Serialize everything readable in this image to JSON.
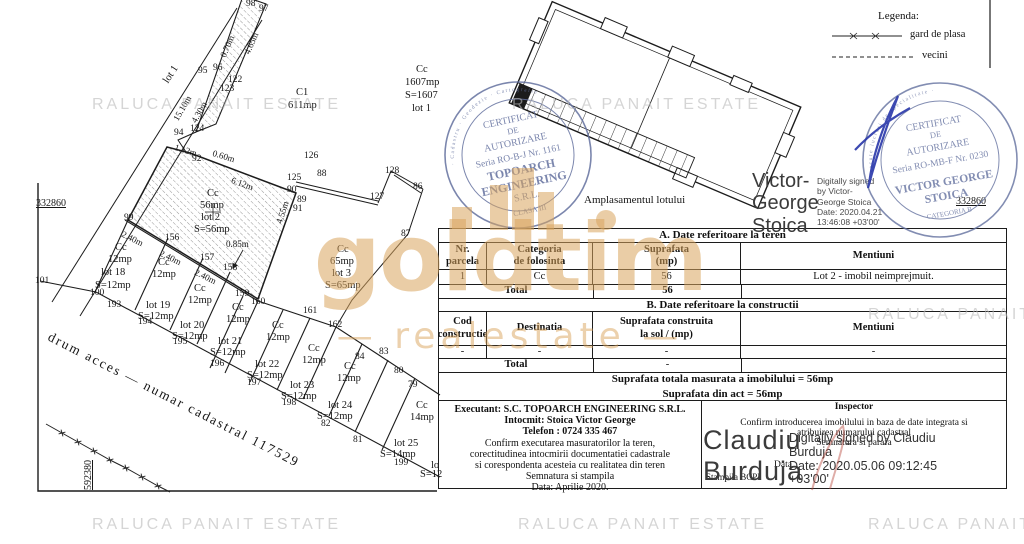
{
  "watermarks": {
    "raluca": "RALUCA PANAIT ESTATE",
    "brand": "goldtim",
    "brand_sub": "— realestate —"
  },
  "legend": {
    "title": "Legenda:",
    "fence_label": "gard de plasa",
    "vecini_label": "vecini"
  },
  "map": {
    "site_plan_caption": "Amplasamentul lotului",
    "labels": [
      {
        "t": "98",
        "x": 246,
        "y": 0
      },
      {
        "t": "97",
        "x": 259,
        "y": 5
      },
      {
        "t": "95",
        "x": 198,
        "y": 67
      },
      {
        "t": "96",
        "x": 213,
        "y": 64
      },
      {
        "t": "122",
        "x": 228,
        "y": 76
      },
      {
        "t": "123",
        "x": 220,
        "y": 85
      },
      {
        "t": "124",
        "x": 190,
        "y": 125
      },
      {
        "t": "94",
        "x": 174,
        "y": 129
      },
      {
        "t": "92",
        "x": 192,
        "y": 155
      },
      {
        "t": "126",
        "x": 304,
        "y": 152
      },
      {
        "t": "125",
        "x": 287,
        "y": 174
      },
      {
        "t": "88",
        "x": 317,
        "y": 170
      },
      {
        "t": "90",
        "x": 287,
        "y": 186
      },
      {
        "t": "89",
        "x": 297,
        "y": 196
      },
      {
        "t": "91",
        "x": 293,
        "y": 205
      },
      {
        "t": "99",
        "x": 124,
        "y": 214
      },
      {
        "t": "156",
        "x": 165,
        "y": 234
      },
      {
        "t": "157",
        "x": 200,
        "y": 254
      },
      {
        "t": "158",
        "x": 223,
        "y": 264
      },
      {
        "t": "159",
        "x": 235,
        "y": 290
      },
      {
        "t": "160",
        "x": 251,
        "y": 298
      },
      {
        "t": "161",
        "x": 303,
        "y": 307
      },
      {
        "t": "162",
        "x": 328,
        "y": 321
      },
      {
        "t": "84",
        "x": 355,
        "y": 353
      },
      {
        "t": "83",
        "x": 379,
        "y": 348
      },
      {
        "t": "80",
        "x": 394,
        "y": 367
      },
      {
        "t": "79",
        "x": 408,
        "y": 381
      },
      {
        "t": "82",
        "x": 321,
        "y": 420
      },
      {
        "t": "81",
        "x": 353,
        "y": 436
      },
      {
        "t": "199",
        "x": 394,
        "y": 459
      },
      {
        "t": "198",
        "x": 282,
        "y": 399
      },
      {
        "t": "197",
        "x": 247,
        "y": 379
      },
      {
        "t": "196",
        "x": 210,
        "y": 360
      },
      {
        "t": "195",
        "x": 173,
        "y": 338
      },
      {
        "t": "194",
        "x": 138,
        "y": 318
      },
      {
        "t": "193",
        "x": 107,
        "y": 301
      },
      {
        "t": "100",
        "x": 90,
        "y": 289
      },
      {
        "t": "101",
        "x": 35,
        "y": 277
      },
      {
        "t": "86",
        "x": 413,
        "y": 183
      },
      {
        "t": "87",
        "x": 401,
        "y": 230
      },
      {
        "t": "127",
        "x": 370,
        "y": 193
      },
      {
        "t": "128",
        "x": 385,
        "y": 167
      },
      {
        "t": "0.70m",
        "x": 219,
        "y": 55,
        "r": -66,
        "c": "d"
      },
      {
        "t": "4.65m",
        "x": 243,
        "y": 52,
        "r": -66,
        "c": "d"
      },
      {
        "t": "15.10m",
        "x": 172,
        "y": 118,
        "r": -60,
        "c": "d"
      },
      {
        "t": "4.30m",
        "x": 190,
        "y": 120,
        "r": -60,
        "c": "d"
      },
      {
        "t": "1.12m",
        "x": 176,
        "y": 143,
        "r": 17,
        "c": "d"
      },
      {
        "t": "0.60m",
        "x": 214,
        "y": 149,
        "r": 17,
        "c": "d"
      },
      {
        "t": "6.12m",
        "x": 233,
        "y": 176,
        "r": 20,
        "c": "d"
      },
      {
        "t": "2.40m",
        "x": 124,
        "y": 230,
        "r": 26,
        "c": "d"
      },
      {
        "t": "2.40m",
        "x": 162,
        "y": 249,
        "r": 26,
        "c": "d"
      },
      {
        "t": "2.40m",
        "x": 197,
        "y": 268,
        "r": 26,
        "c": "d"
      },
      {
        "t": "0.85m",
        "x": 226,
        "y": 240,
        "c": "d"
      },
      {
        "t": "4.55m",
        "x": 275,
        "y": 222,
        "r": -72,
        "c": "d"
      },
      {
        "t": "lot 1",
        "x": 162,
        "y": 80,
        "r": -57,
        "c": "l"
      },
      {
        "t": "Cc",
        "x": 207,
        "y": 189,
        "c": "l"
      },
      {
        "t": "56mp",
        "x": 200,
        "y": 201,
        "c": "l"
      },
      {
        "t": "lot 2",
        "x": 201,
        "y": 213,
        "c": "l"
      },
      {
        "t": "S=56mp",
        "x": 194,
        "y": 225,
        "c": "l"
      },
      {
        "t": "C1",
        "x": 296,
        "y": 88,
        "c": "l"
      },
      {
        "t": "611mp",
        "x": 288,
        "y": 101,
        "c": "l"
      },
      {
        "t": "Cc",
        "x": 416,
        "y": 65,
        "c": "l"
      },
      {
        "t": "1607mp",
        "x": 405,
        "y": 78,
        "c": "l"
      },
      {
        "t": "S=1607",
        "x": 405,
        "y": 91,
        "c": "l"
      },
      {
        "t": "lot 1",
        "x": 412,
        "y": 104,
        "c": "l"
      },
      {
        "t": "Cc",
        "x": 337,
        "y": 245,
        "c": "l"
      },
      {
        "t": "65mp",
        "x": 330,
        "y": 257,
        "c": "l"
      },
      {
        "t": "lot 3",
        "x": 332,
        "y": 269,
        "c": "l"
      },
      {
        "t": "S=65mp",
        "x": 325,
        "y": 281,
        "c": "l"
      },
      {
        "t": "Cc",
        "x": 115,
        "y": 243,
        "c": "l"
      },
      {
        "t": "12mp",
        "x": 108,
        "y": 255,
        "c": "l"
      },
      {
        "t": "lot 18",
        "x": 101,
        "y": 268,
        "c": "l"
      },
      {
        "t": "S=12mp",
        "x": 95,
        "y": 281,
        "c": "l"
      },
      {
        "t": "Cc",
        "x": 158,
        "y": 258,
        "c": "l"
      },
      {
        "t": "12mp",
        "x": 152,
        "y": 270,
        "c": "l"
      },
      {
        "t": "lot 19",
        "x": 146,
        "y": 301,
        "c": "l"
      },
      {
        "t": "S=12mp",
        "x": 138,
        "y": 312,
        "c": "l"
      },
      {
        "t": "Cc",
        "x": 194,
        "y": 284,
        "c": "l"
      },
      {
        "t": "12mp",
        "x": 188,
        "y": 296,
        "c": "l"
      },
      {
        "t": "lot 20",
        "x": 180,
        "y": 321,
        "c": "l"
      },
      {
        "t": "S=12mp",
        "x": 172,
        "y": 332,
        "c": "l"
      },
      {
        "t": "Cc",
        "x": 232,
        "y": 303,
        "c": "l"
      },
      {
        "t": "12mp",
        "x": 226,
        "y": 315,
        "c": "l"
      },
      {
        "t": "lot 21",
        "x": 218,
        "y": 337,
        "c": "l"
      },
      {
        "t": "S=12mp",
        "x": 210,
        "y": 348,
        "c": "l"
      },
      {
        "t": "Cc",
        "x": 272,
        "y": 321,
        "c": "l"
      },
      {
        "t": "12mp",
        "x": 266,
        "y": 333,
        "c": "l"
      },
      {
        "t": "lot 22",
        "x": 255,
        "y": 360,
        "c": "l"
      },
      {
        "t": "S=12mp",
        "x": 247,
        "y": 371,
        "c": "l"
      },
      {
        "t": "Cc",
        "x": 308,
        "y": 344,
        "c": "l"
      },
      {
        "t": "12mp",
        "x": 302,
        "y": 356,
        "c": "l"
      },
      {
        "t": "lot 23",
        "x": 290,
        "y": 381,
        "c": "l"
      },
      {
        "t": "S=12mp",
        "x": 281,
        "y": 392,
        "c": "l"
      },
      {
        "t": "Cc",
        "x": 344,
        "y": 362,
        "c": "l"
      },
      {
        "t": "12mp",
        "x": 337,
        "y": 374,
        "c": "l"
      },
      {
        "t": "lot 24",
        "x": 328,
        "y": 401,
        "c": "l"
      },
      {
        "t": "S=12mp",
        "x": 317,
        "y": 412,
        "c": "l"
      },
      {
        "t": "Cc",
        "x": 416,
        "y": 401,
        "c": "l"
      },
      {
        "t": "14mp",
        "x": 410,
        "y": 413,
        "c": "l"
      },
      {
        "t": "lot 25",
        "x": 394,
        "y": 439,
        "c": "l"
      },
      {
        "t": "S=14mp",
        "x": 380,
        "y": 450,
        "c": "l"
      },
      {
        "t": "lo",
        "x": 431,
        "y": 461,
        "c": "l"
      },
      {
        "t": "S=12",
        "x": 420,
        "y": 470,
        "c": "l"
      },
      {
        "t": "332860",
        "x": 36,
        "y": 199,
        "c": "g"
      },
      {
        "t": "332860",
        "x": 956,
        "y": 197,
        "c": "g"
      },
      {
        "t": "592380",
        "x": 84,
        "y": 490,
        "r": -90,
        "c": "g"
      },
      {
        "t": "drum acces — numar cadastral 117529",
        "x": 52,
        "y": 330,
        "r": 27,
        "c": "road"
      }
    ]
  },
  "stamps": {
    "topoarch": {
      "ring": "Persoana juridica autorizata de ANCPI · Cadastru · Geodezie · Cartografie ·",
      "l1": "CERTIFICAT",
      "l2": "DE",
      "l3": "AUTORIZARE",
      "l4": "Seria RO-B-J Nr. 1161",
      "l5": "TOPOARCH",
      "l6": "ENGINEERING",
      "l7": "S.R.L.",
      "l8": "CLASA III"
    },
    "stoica": {
      "ring": "Persoana fizica autorizata sa execute lucrari de specialitate ·",
      "l1": "CERTIFICAT",
      "l2": "DE",
      "l3": "AUTORIZARE",
      "l4": "Seria RO-MB-F Nr. 0230",
      "l5": "VICTOR GEORGE",
      "l6": "STOICA",
      "l7": "CATEGORIA B"
    }
  },
  "signatures": {
    "stoica": {
      "name": "Victor-\nGeorge\nStoica",
      "details": "Digitally signed\nby Victor-\nGeorge Stoica\nDate: 2020.04.21\n13:46:08 +03'00'"
    },
    "burduja": {
      "name": "Claudiu\nBurduja",
      "details": "Digitally signed by Claudiu\nBurduja\nDate: 2020.05.06 09:12:45\n+03'00'"
    }
  },
  "tables": {
    "section_a_title": "A. Date referitoare la teren",
    "a": {
      "h0": "Nr.\nparcela",
      "h1": "Categoria\nde folosinta",
      "h2": "Suprafata\n(mp)",
      "h3": "Mentiuni",
      "r0": [
        "1",
        "Cc",
        "56",
        "Lot 2 - imobil neimprejmuit."
      ],
      "total_label": "Total",
      "total_value": "56"
    },
    "section_b_title": "B. Date referitoare la constructii",
    "b": {
      "h0": "Cod\nconstructie",
      "h1": "Destinatia",
      "h2": "Suprafata construita\nla sol / (mp)",
      "h3": "Mentiuni",
      "r0": [
        "-",
        "-",
        "-",
        "-"
      ],
      "total_label": "Total",
      "total_value": "-"
    },
    "summary_line1": "Suprafata totala masurata a imobilului =  56mp",
    "summary_line2": "Suprafata din act = 56mp",
    "executant": {
      "line1": "Executant: S.C. TOPOARCH ENGINEERING S.R.L.",
      "line2": "Intocmit: Stoica Victor George",
      "line3": "Telefon : 0724  335 467",
      "body": "Confirm executarea masuratorilor la teren,\ncorectitudinea intocmirii documentatiei cadastrale\nsi corespondenta acesteia cu realitatea din teren\nSemnatura si stampila\nData: Aprilie  2020."
    },
    "inspector": {
      "title": "Inspector",
      "body": "Confirm introducerea imobilului in baza de date integrata si\natribuirea numarului cadastral",
      "sign_label": "Semnatura si parafa",
      "stamp_label": "Stampila BCPI",
      "date_label": "Data"
    }
  }
}
